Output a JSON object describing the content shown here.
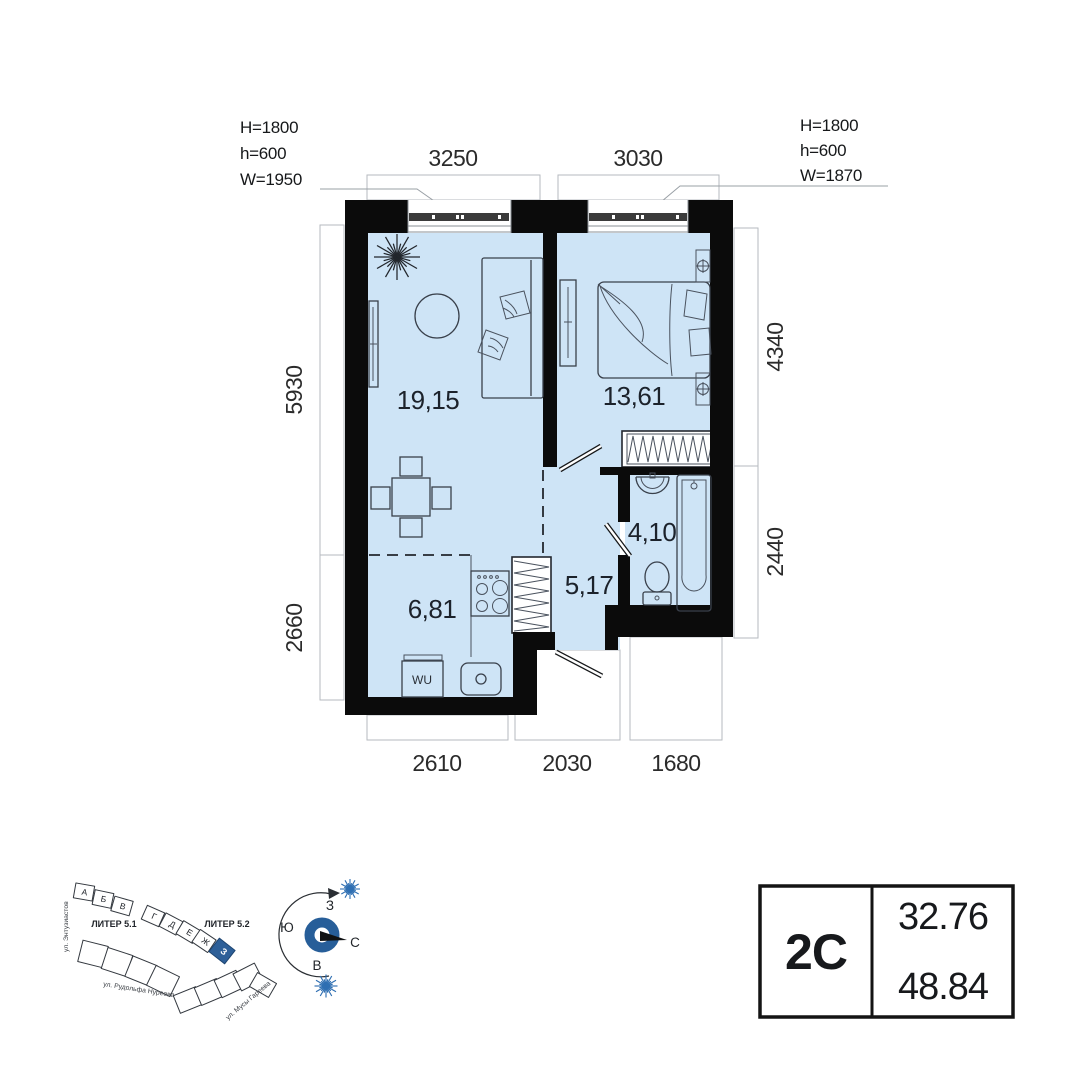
{
  "plan": {
    "areas": {
      "living": "19,15",
      "bedroom": "13,61",
      "bathroom": "4,10",
      "hallway": "5,17",
      "kitchen": "6,81"
    },
    "dims": {
      "top_living": "3250",
      "top_bedroom": "3030",
      "left_upper": "5930",
      "left_lower": "2660",
      "right_upper": "4340",
      "right_lower": "2440",
      "bottom_kitchen": "2610",
      "bottom_hall": "2030",
      "bottom_bath": "1680"
    },
    "window_left": {
      "line1": "H=1800",
      "line2": "h=600",
      "line3": "W=1950"
    },
    "window_right": {
      "line1": "H=1800",
      "line2": "h=600",
      "line3": "W=1870"
    },
    "washer_label": "WU"
  },
  "summary": {
    "type": "2С",
    "area_upper": "32.76",
    "area_lower": "48.84"
  },
  "compass": {
    "n": "С",
    "s": "Ю",
    "w": "З",
    "e": "В"
  },
  "sitemap": {
    "liter_left": "ЛИТЕР 5.1",
    "liter_right": "ЛИТЕР 5.2",
    "letters": [
      "А",
      "Б",
      "В",
      "Г",
      "Д",
      "Е",
      "Ж",
      "З"
    ],
    "street_left": "ул. Энтузиастов",
    "street_bottom": "ул. Рудольфа Нуреева",
    "street_right": "ул. Мусы Гареева"
  },
  "colors": {
    "floor": "#cee4f6",
    "wall": "#0b0b0b",
    "accent_blue": "#2d5f98",
    "star_blue": "#2f6fb2",
    "furniture_line": "#39404b",
    "dim_line": "#b6babf"
  }
}
